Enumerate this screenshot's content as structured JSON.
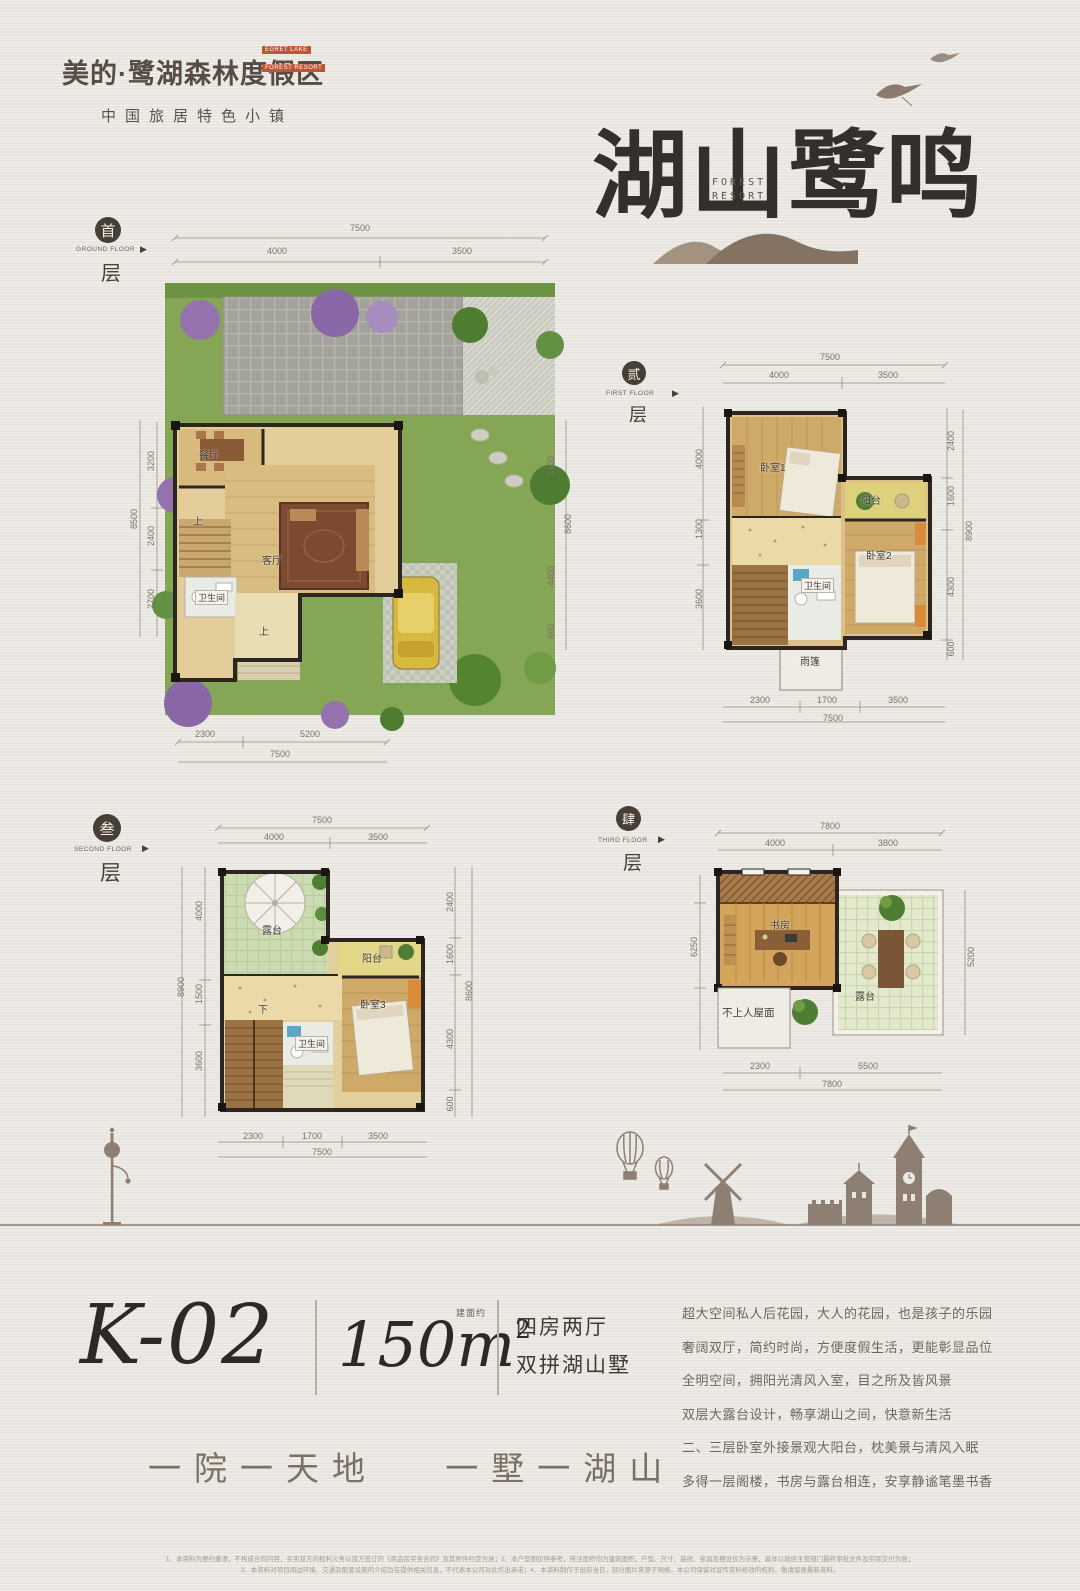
{
  "brand": {
    "badge": [
      "EGRET LAKE",
      "FOREST RESORT"
    ],
    "name": "美的·鹭湖森林度假区",
    "tagline": "中国旅居特色小镇"
  },
  "hero": {
    "title": "湖山鹭鸣",
    "sub1": "FOREST",
    "sub2": "RESORT"
  },
  "floors": [
    {
      "num": "首",
      "en": "GROUND FLOOR",
      "suffix": "层",
      "rooms": [
        "餐厅",
        "客厅",
        "卫生间",
        "上",
        "上"
      ],
      "top": [
        "7500",
        "4000",
        "3500"
      ],
      "left": [
        "3200",
        "2400",
        "2700",
        "8500"
      ],
      "right": [
        "3300",
        "4400",
        "600",
        "8600"
      ],
      "bottom": [
        "2300",
        "5200",
        "7500"
      ]
    },
    {
      "num": "贰",
      "en": "FIRST FLOOR",
      "suffix": "层",
      "rooms": [
        "卧室1",
        "阳台",
        "卧室2",
        "卫生间",
        "雨篷"
      ],
      "top": [
        "7500",
        "4000",
        "3500"
      ],
      "left": [
        "4000",
        "1300",
        "3600"
      ],
      "right": [
        "2400",
        "1600",
        "4300",
        "600",
        "8900"
      ],
      "bottom": [
        "2300",
        "1700",
        "3500",
        "7500"
      ]
    },
    {
      "num": "叁",
      "en": "SECOND FLOOR",
      "suffix": "层",
      "rooms": [
        "露台",
        "阳台",
        "卧室3",
        "卫生间",
        "下"
      ],
      "top": [
        "7500",
        "4000",
        "3500"
      ],
      "left": [
        "4000",
        "1500",
        "3600",
        "8900"
      ],
      "right": [
        "2400",
        "1600",
        "4300",
        "600",
        "8600"
      ],
      "bottom": [
        "2300",
        "1700",
        "3500",
        "7500"
      ]
    },
    {
      "num": "肆",
      "en": "THIRD FLOOR",
      "suffix": "层",
      "rooms": [
        "书房",
        "露台",
        "不上人屋面"
      ],
      "top": [
        "7800",
        "4000",
        "3800"
      ],
      "left": [
        "6250"
      ],
      "right": [
        "5200"
      ],
      "bottom": [
        "2300",
        "5500",
        "7800"
      ]
    }
  ],
  "unit": {
    "code": "K-02",
    "area_note": "建面约",
    "area": "150m",
    "area_sup": "2",
    "layout1": "四房两厅",
    "layout2": "双拼湖山墅"
  },
  "slogan": "一院一天地　 一墅一湖山",
  "description": [
    "超大空间私人后花园，大人的花园，也是孩子的乐园",
    "奢阔双厅，简约时尚，方便度假生活，更能彰显品位",
    "全明空间，拥阳光清风入室，目之所及皆风景",
    "双层大露台设计，畅享湖山之间，快意新生活",
    "二、三层卧室外接景观大阳台，枕美景与清风入眠",
    "多得一层阁楼，书房与露台相连，安享静谧笔墨书香"
  ],
  "disclaimer": [
    "1、本资料为要约邀请，不构成合同内容，买卖双方的权利义务以双方签订的《商品房买卖合同》及其附件约定为准；2、本户型图仅供参考，所注面积均为建筑面积，户型、尺寸、装修、家具及摆设仅为示意，具体以政府主管部门最终审批文件及实际交付为准；",
    "3、本资料对项目周边环境、交通及配套设施的介绍旨在提供相关信息，不代表本公司对此作出承诺；4、本资料制作于出街当日，部分图片来源于网络，本公司保留对宣传资料修改的权利，敬请留意最新资料。"
  ],
  "colors": {
    "accent_red": "#bf5436",
    "ink": "#33302c",
    "taupe": "#8d7f72",
    "lawn": "#85a654"
  }
}
